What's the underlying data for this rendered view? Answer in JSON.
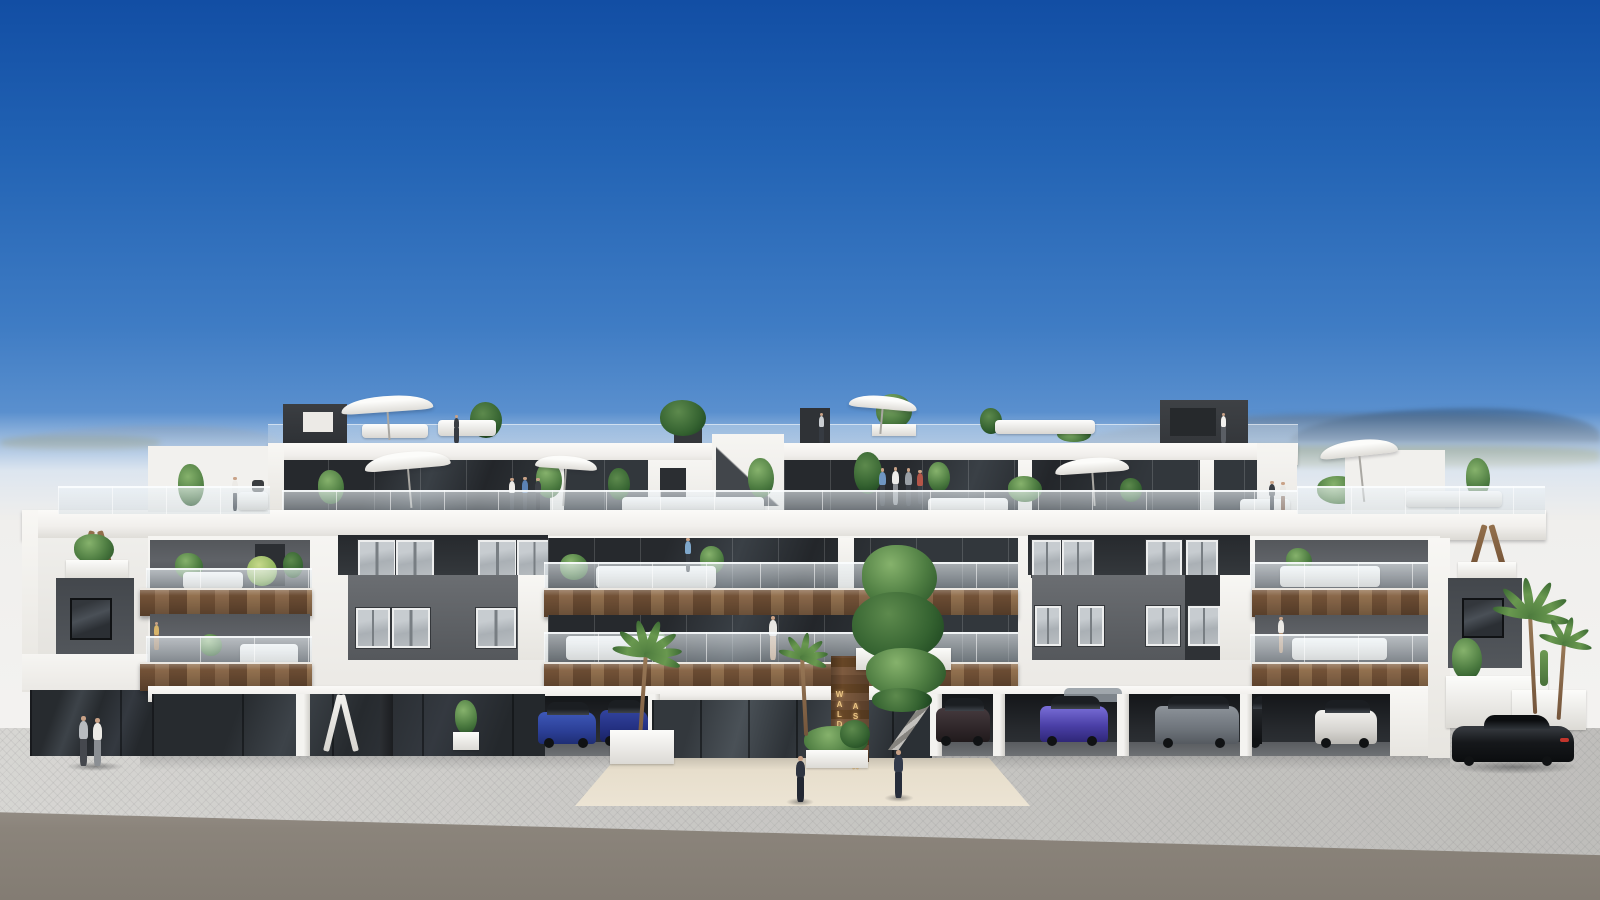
{
  "scene": {
    "type": "architectural-exterior-render",
    "description": "Front elevation render of a modern white three-storey apartment residence with anthracite recesses, timber balcony fascias, glass balustrades, rooftop terraces with parasols, ground-floor parking and a glazed entrance lobby",
    "sign": {
      "line1": "WALDORF",
      "line2": "ASTORIA"
    },
    "environment": {
      "sky": "clear blue gradient sky",
      "background": "hazy horizon with a distant mountain ridge and low greenery on the right",
      "foreground": "light paved sidewalk with an asphalt road strip at the bottom"
    },
    "colors": {
      "sky_top": "#124ea4",
      "sky_horizon": "#9dc0e4",
      "building_white": "#f5f4f1",
      "anthracite": "#2b2e32",
      "mid_grey_panel": "#64676b",
      "timber": "#82603f",
      "glazing": "#2e3236",
      "glass_balustrade": "#dfe8ee",
      "sidewalk": "#c8c7c4",
      "road": "#8e867c",
      "entrance_walkway": "#e2d8c4",
      "sign_gold": "#eac686",
      "foliage": "#4d7c41",
      "mountains": "#5d7ca0"
    }
  }
}
